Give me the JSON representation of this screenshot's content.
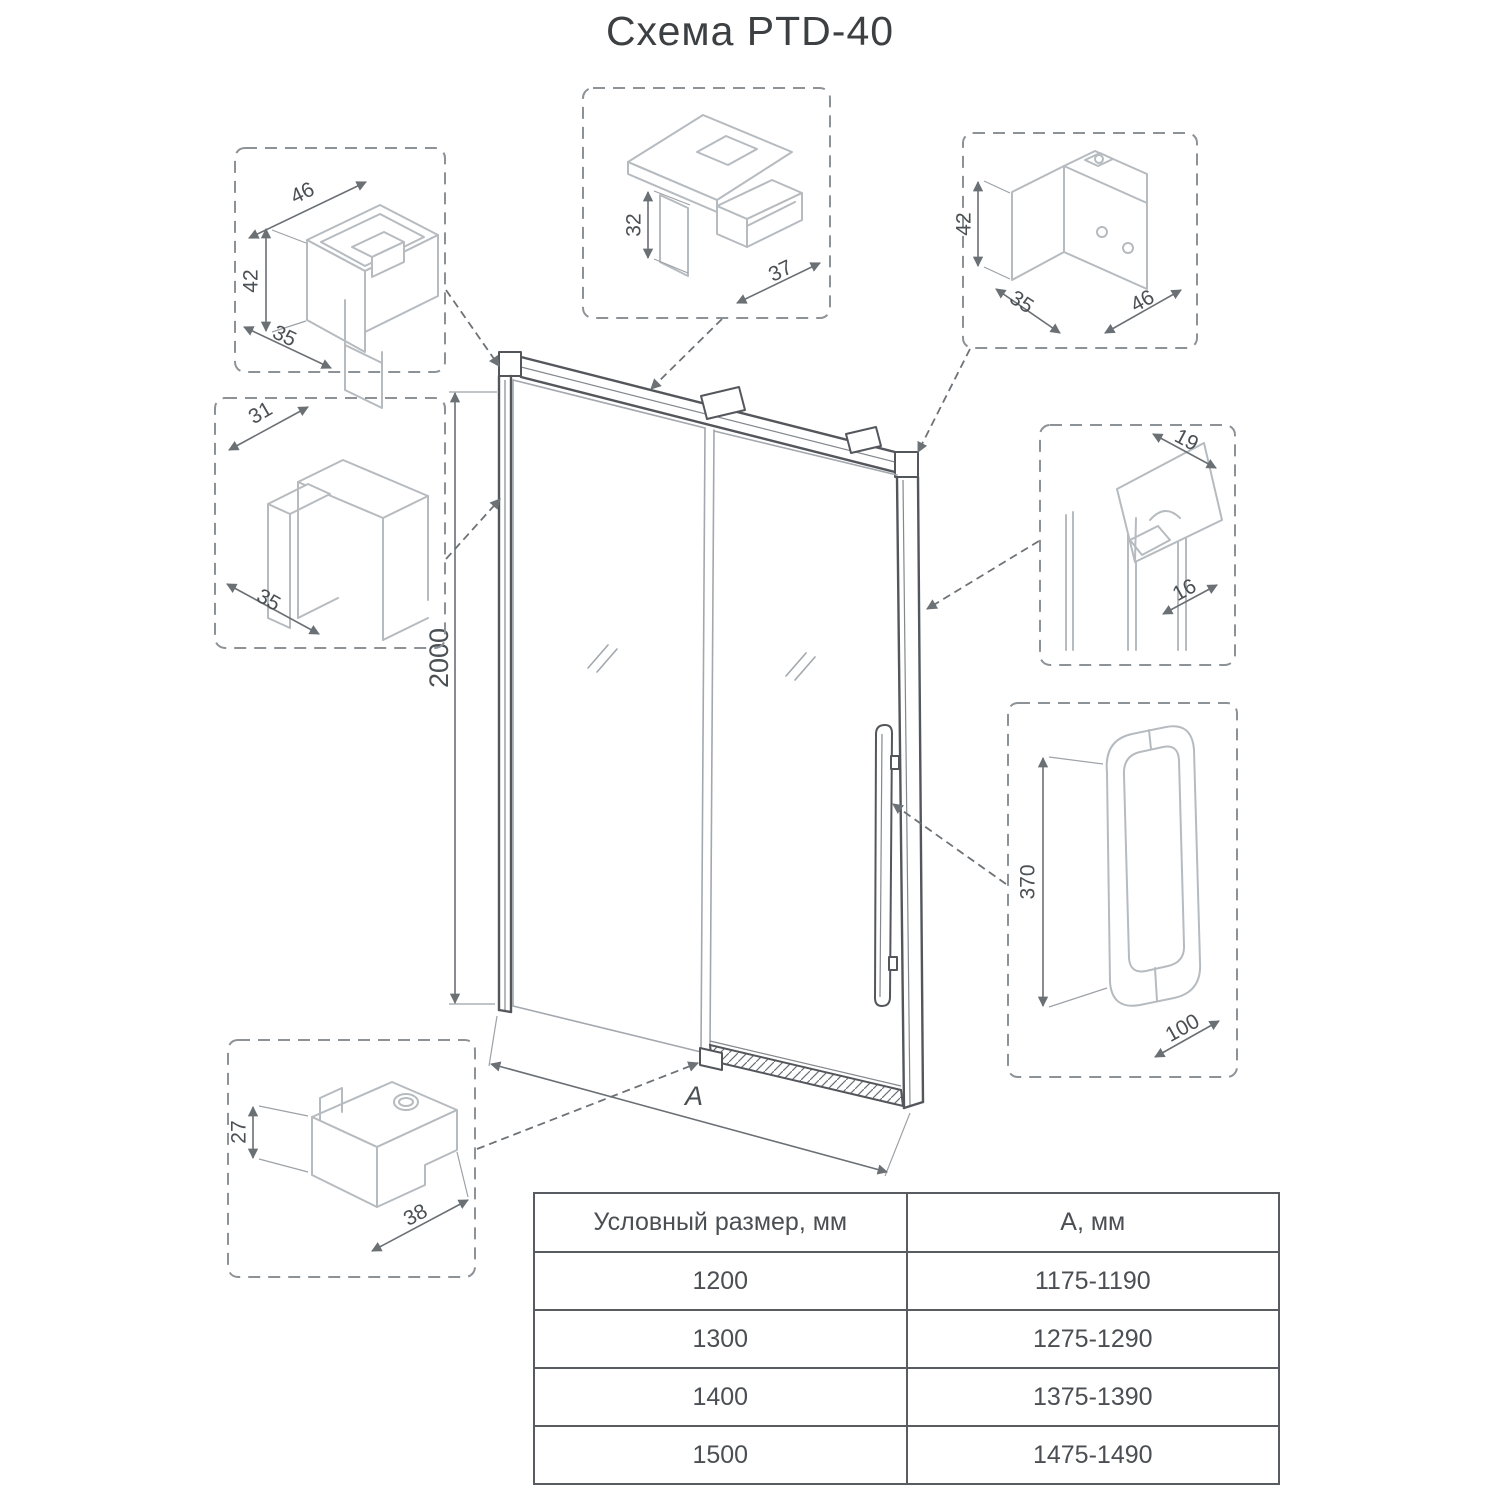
{
  "title": "Схема PTD-40",
  "drawing": {
    "height_label": "2000",
    "width_label": "A"
  },
  "details": {
    "top_left_bracket": {
      "dim_top": "46",
      "dim_side": "42",
      "dim_bottom": "35"
    },
    "rail_profile": {
      "dim_height": "32",
      "dim_depth": "37"
    },
    "top_right_bracket": {
      "dim_side": "42",
      "dim_bottom_left": "35",
      "dim_bottom_right": "46"
    },
    "wall_profile": {
      "dim_top": "31",
      "dim_bottom": "35"
    },
    "seal_profile": {
      "dim_top": "19",
      "dim_bottom": "16"
    },
    "handle": {
      "dim_height": "370",
      "dim_width": "100"
    },
    "bottom_bracket": {
      "dim_side": "27",
      "dim_bottom": "38"
    }
  },
  "table": {
    "headers": [
      "Условный размер, мм",
      "А, мм"
    ],
    "rows": [
      [
        "1200",
        "1175-1190"
      ],
      [
        "1300",
        "1275-1290"
      ],
      [
        "1400",
        "1375-1390"
      ],
      [
        "1500",
        "1475-1490"
      ]
    ]
  }
}
